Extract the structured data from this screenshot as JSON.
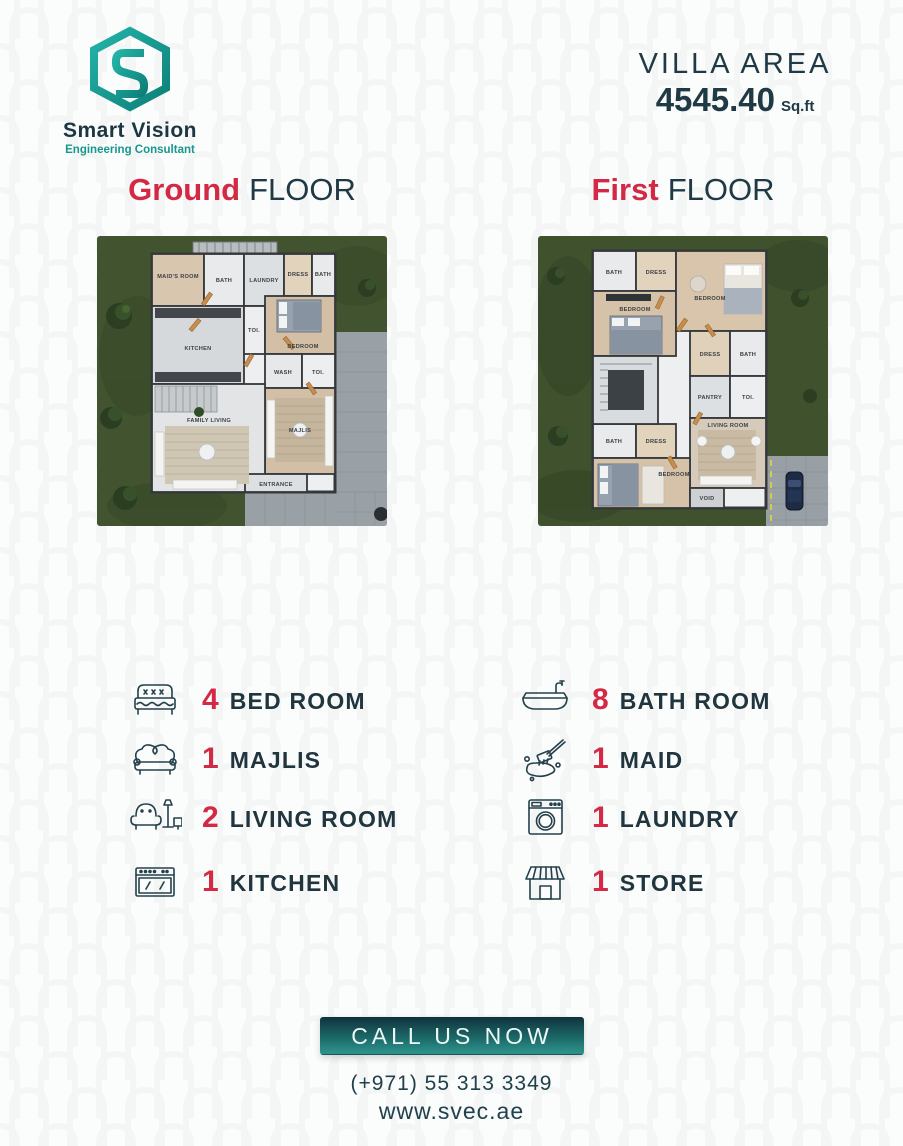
{
  "brand": {
    "name": "Smart Vision",
    "tagline": "Engineering Consultant"
  },
  "villa_area": {
    "label": "VILLA AREA",
    "value": "4545.40",
    "unit": "Sq.ft"
  },
  "floors": [
    {
      "accent": "Ground",
      "rest": "FLOOR"
    },
    {
      "accent": "First",
      "rest": "FLOOR"
    }
  ],
  "plans": {
    "ground": {
      "rooms": [
        "MAID'S ROOM",
        "BATH",
        "LAUNDRY",
        "DRESS",
        "BATH",
        "KITCHEN",
        "TOI.",
        "BEDROOM",
        "WASH",
        "TOI.",
        "FAMILY LIVING",
        "MAJLIS",
        "ENTRANCE"
      ]
    },
    "first": {
      "rooms": [
        "BATH",
        "DRESS",
        "BEDROOM",
        "BEDROOM",
        "DRESS",
        "BATH",
        "PANTRY",
        "TOI.",
        "LIVING ROOM",
        "BATH",
        "DRESS",
        "BEDROOM",
        "VOID"
      ]
    }
  },
  "features": {
    "left": [
      {
        "count": "4",
        "label": "BED ROOM",
        "icon": "bed-icon"
      },
      {
        "count": "1",
        "label": "MAJLIS",
        "icon": "sofa-icon"
      },
      {
        "count": "2",
        "label": "LIVING ROOM",
        "icon": "armchair-lamp-icon"
      },
      {
        "count": "1",
        "label": "KITCHEN",
        "icon": "stove-icon"
      }
    ],
    "right": [
      {
        "count": "8",
        "label": "BATH ROOM",
        "icon": "bathtub-icon"
      },
      {
        "count": "1",
        "label": "MAID",
        "icon": "cleaning-mop-icon"
      },
      {
        "count": "1",
        "label": "LAUNDRY",
        "icon": "washing-machine-icon"
      },
      {
        "count": "1",
        "label": "STORE",
        "icon": "shop-icon"
      }
    ]
  },
  "cta": {
    "button": "CALL US NOW",
    "phone": "(+971) 55 313 3349",
    "website": "www.svec.ae"
  },
  "colors": {
    "accent_red": "#d32945",
    "dark_navy": "#203a45",
    "teal": "#17988e",
    "button_top": "#10333d",
    "button_bottom": "#2f948d",
    "grass": "#42542f"
  }
}
